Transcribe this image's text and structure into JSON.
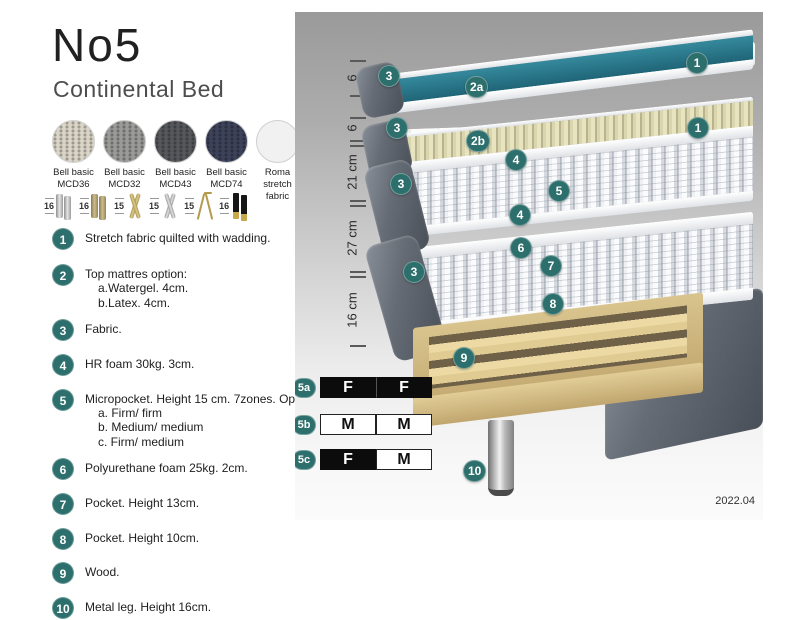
{
  "header": {
    "title": "No5",
    "subtitle": "Continental Bed"
  },
  "fabric_swatches": [
    {
      "line1": "Bell basic",
      "line2": "MCD36",
      "color": "#d9d4c6"
    },
    {
      "line1": "Bell basic",
      "line2": "MCD32",
      "color": "#9a9a98"
    },
    {
      "line1": "Bell basic",
      "line2": "MCD43",
      "color": "#54575b"
    },
    {
      "line1": "Bell basic",
      "line2": "MCD74",
      "color": "#3d425a"
    },
    {
      "line1": "Roma",
      "line2": "stretch fabric",
      "color": "#f1f1f1"
    }
  ],
  "leg_options": [
    {
      "height": "16",
      "style": "cylinder-silver"
    },
    {
      "height": "16",
      "style": "cylinder-brass"
    },
    {
      "height": "15",
      "style": "twist-gold"
    },
    {
      "height": "15",
      "style": "twist-silver"
    },
    {
      "height": "15",
      "style": "hairpin-gold"
    },
    {
      "height": "16",
      "style": "block-black-gold"
    }
  ],
  "features": [
    {
      "num": "1",
      "text": "Stretch fabric quilted with wadding."
    },
    {
      "num": "2",
      "text": "Top mattres option:",
      "sub0": "a.Watergel. 4cm.",
      "sub1": "b.Latex. 4cm."
    },
    {
      "num": "3",
      "text": "Fabric."
    },
    {
      "num": "4",
      "text": "HR foam 30kg. 3cm."
    },
    {
      "num": "5",
      "text": "Micropocket. Height 15 cm. 7zones. Option:",
      "sub0": "a. Firm/ firm",
      "sub1": "b. Medium/ medium",
      "sub2": "c. Firm/ medium"
    },
    {
      "num": "6",
      "text": "Polyurethane foam 25kg. 2cm."
    },
    {
      "num": "7",
      "text": "Pocket. Height 13cm."
    },
    {
      "num": "8",
      "text": "Pocket. Height 10cm."
    },
    {
      "num": "9",
      "text": "Wood."
    },
    {
      "num": "10",
      "text": "Metal leg. Height 16cm."
    }
  ],
  "diagram": {
    "scale": [
      {
        "label": "6"
      },
      {
        "label": "6"
      },
      {
        "label": "21 cm"
      },
      {
        "label": "27 cm"
      },
      {
        "label": "16 cm"
      }
    ],
    "badges": [
      {
        "label": "1"
      },
      {
        "label": "2a"
      },
      {
        "label": "3"
      },
      {
        "label": "1"
      },
      {
        "label": "3"
      },
      {
        "label": "2b"
      },
      {
        "label": "4"
      },
      {
        "label": "5"
      },
      {
        "label": "4"
      },
      {
        "label": "3"
      },
      {
        "label": "6"
      },
      {
        "label": "7"
      },
      {
        "label": "3"
      },
      {
        "label": "8"
      },
      {
        "label": "9"
      },
      {
        "label": "10"
      }
    ],
    "firmness_table": [
      {
        "id": "5a",
        "cell0": {
          "label": "F",
          "fill": "dark"
        },
        "cell1": {
          "label": "F",
          "fill": "dark"
        }
      },
      {
        "id": "5b",
        "cell0": {
          "label": "M",
          "fill": "light"
        },
        "cell1": {
          "label": "M",
          "fill": "light"
        }
      },
      {
        "id": "5c",
        "cell0": {
          "label": "F",
          "fill": "dark"
        },
        "cell1": {
          "label": "M",
          "fill": "light"
        }
      }
    ],
    "version": "2022.04"
  },
  "colors": {
    "badge_teal": "#2d6f6c",
    "watergel_teal": "#2a7a8c",
    "latex_beige": "#ddd9ae",
    "wood": "#d9c48e",
    "panel_gray_top": "#9a9a9a"
  }
}
